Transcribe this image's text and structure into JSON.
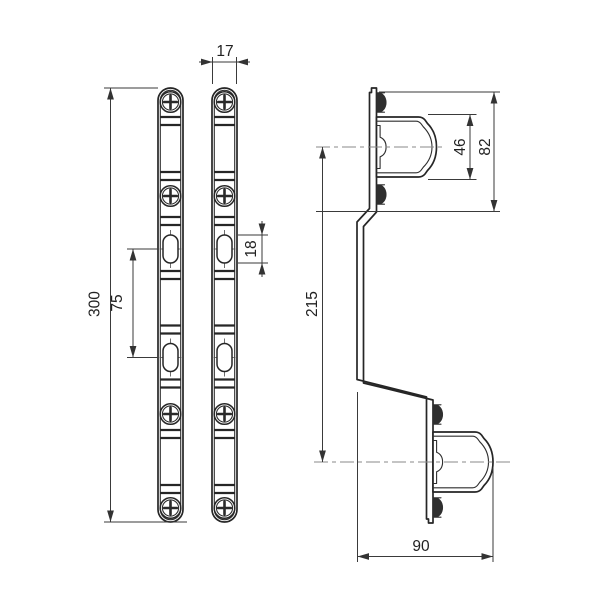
{
  "drawing": {
    "background_color": "#ffffff",
    "line_color": "#262626",
    "dimension_color": "#3a3a3a",
    "centerline_color": "#8a8a8a",
    "dimensions": {
      "rail_width": "17",
      "rail_length": "300",
      "slot_spacing": "75",
      "slot_length": "18",
      "clamp_inner_width": "46",
      "clamp_outer_width": "82",
      "clamp_center_distance": "215",
      "bracket_depth": "90"
    }
  }
}
